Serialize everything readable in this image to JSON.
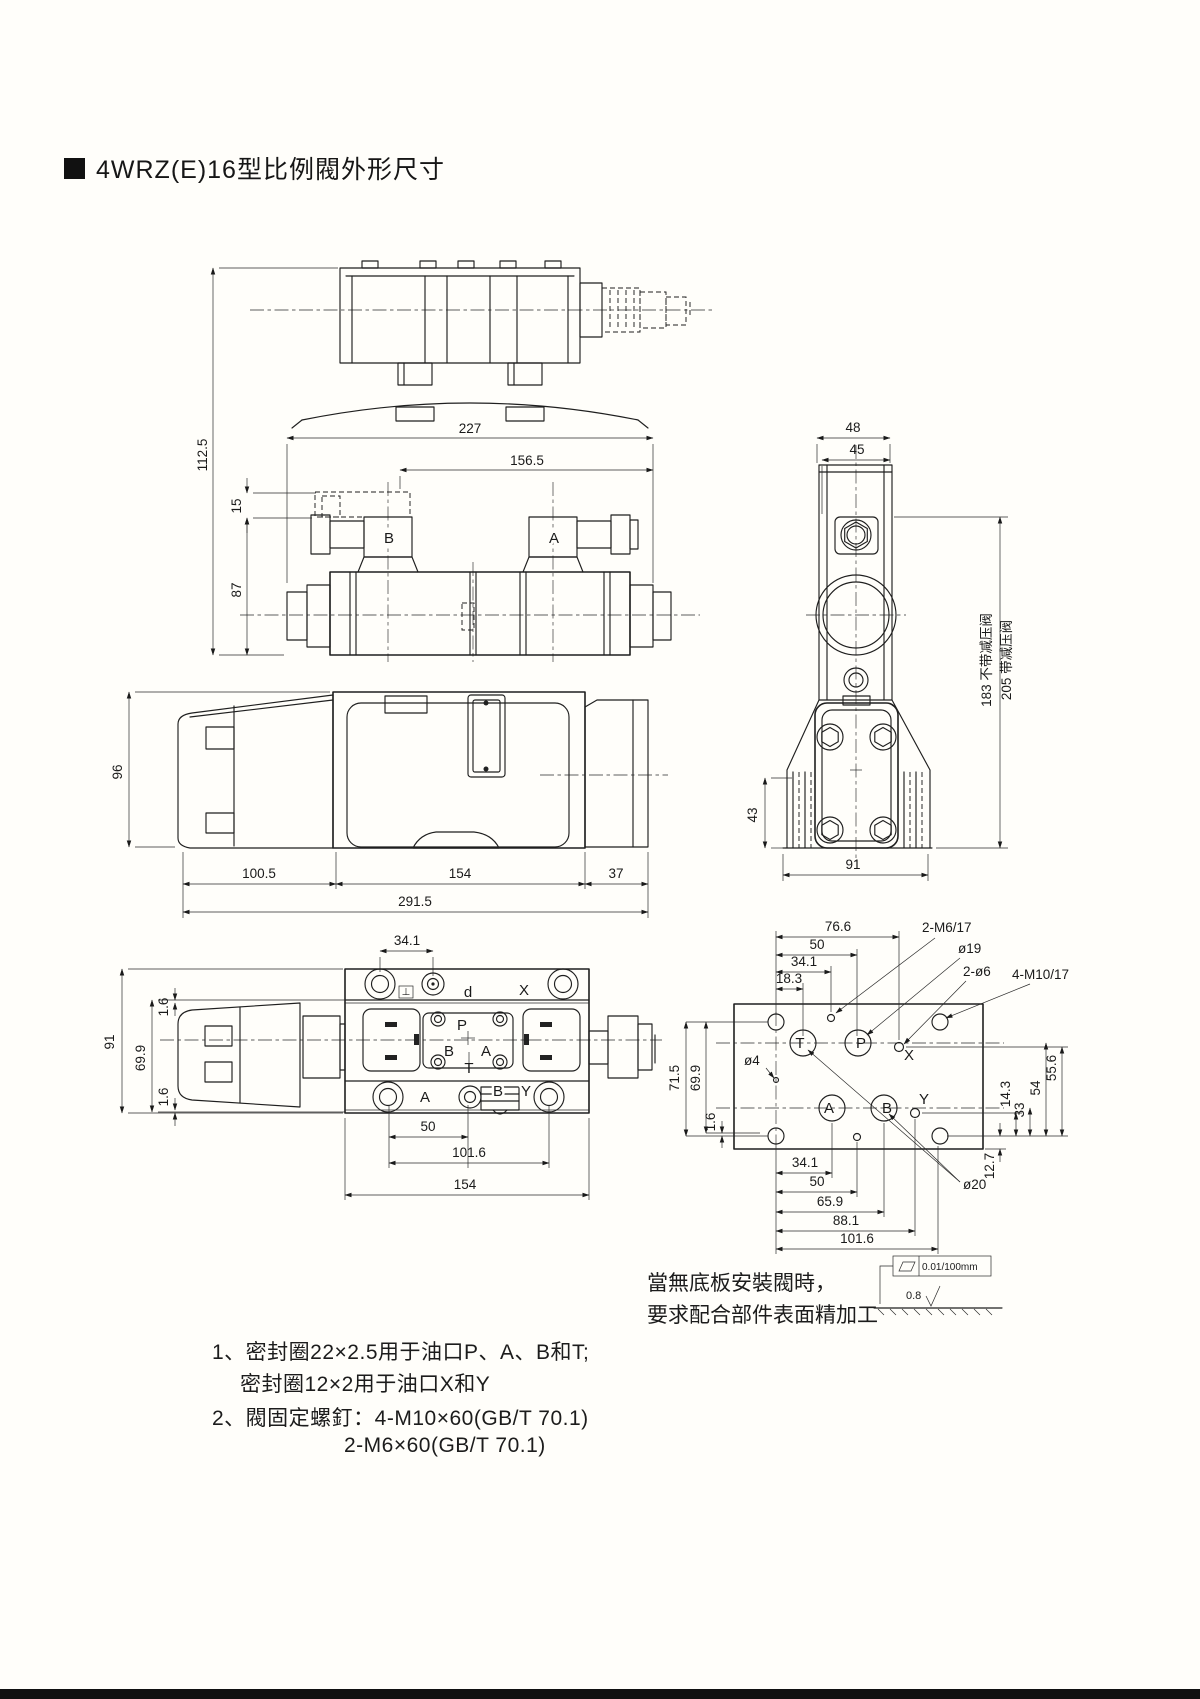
{
  "title": {
    "text": "4WRZ(E)16型比例閥外形尺寸"
  },
  "front_view": {
    "dim_227": "227",
    "dim_156_5": "156.5",
    "dim_112_5": "112.5",
    "dim_15": "15",
    "dim_87": "87",
    "coil_b_label": "B",
    "coil_a_label": "A"
  },
  "side_view": {
    "dim_96": "96",
    "dim_100_5": "100.5",
    "dim_154": "154",
    "dim_37": "37",
    "dim_291_5": "291.5"
  },
  "right_view": {
    "dim_48": "48",
    "dim_45": "45",
    "dim_43": "43",
    "dim_91": "91",
    "dim_183": "183 不带减压阀",
    "dim_205": "205 带减压阀"
  },
  "plan_view": {
    "dim_34_1": "34.1",
    "dim_91": "91",
    "dim_69_9": "69.9",
    "dim_1_6_top": "1.6",
    "dim_1_6_bottom": "1.6",
    "dim_50": "50",
    "dim_101_6": "101.6",
    "dim_154": "154",
    "port_d": "d",
    "port_x": "X",
    "port_p": "P",
    "port_b": "B",
    "port_a": "A",
    "port_t": "T",
    "port_a_bottom": "A",
    "port_b_bottom": "B",
    "port_y": "Y",
    "perp_symbol": "⊥"
  },
  "plate_view": {
    "dim_76_6": "76.6",
    "dim_50_top": "50",
    "dim_34_1_top": "34.1",
    "dim_18_3": "18.3",
    "leader_2_m6": "2-M6/17",
    "leader_o19": "ø19",
    "leader_2_o6": "2-ø6",
    "leader_4_m10": "4-M10/17",
    "leader_o4": "ø4",
    "leader_o20": "ø20",
    "dim_71_5": "71.5",
    "dim_69_9": "69.9",
    "dim_1_6": "1.6",
    "dim_55_6": "55.6",
    "dim_54": "54",
    "dim_33": "33",
    "dim_14_3": "14.3",
    "dim_12_7": "12.7",
    "dim_34_1_bottom": "34.1",
    "dim_50_bottom": "50",
    "dim_65_9": "65.9",
    "dim_88_1": "88.1",
    "dim_101_6": "101.6",
    "port_t": "T",
    "port_p": "P",
    "port_x": "X",
    "port_a": "A",
    "port_b": "B",
    "port_y": "Y"
  },
  "surface_note": {
    "line1": "當無底板安裝閥時，",
    "line2": "要求配合部件表面精加工",
    "flatness_tolerance": "0.01/100mm",
    "roughness": "0.8"
  },
  "notes": {
    "item1_line1": "1、密封圈22×2.5用于油口P、A、B和T;",
    "item1_line2": "密封圈12×2用于油口X和Y",
    "item2_line1": "2、閥固定螺釘：4-M10×60(GB/T 70.1)",
    "item2_line2": "2-M6×60(GB/T 70.1)"
  }
}
